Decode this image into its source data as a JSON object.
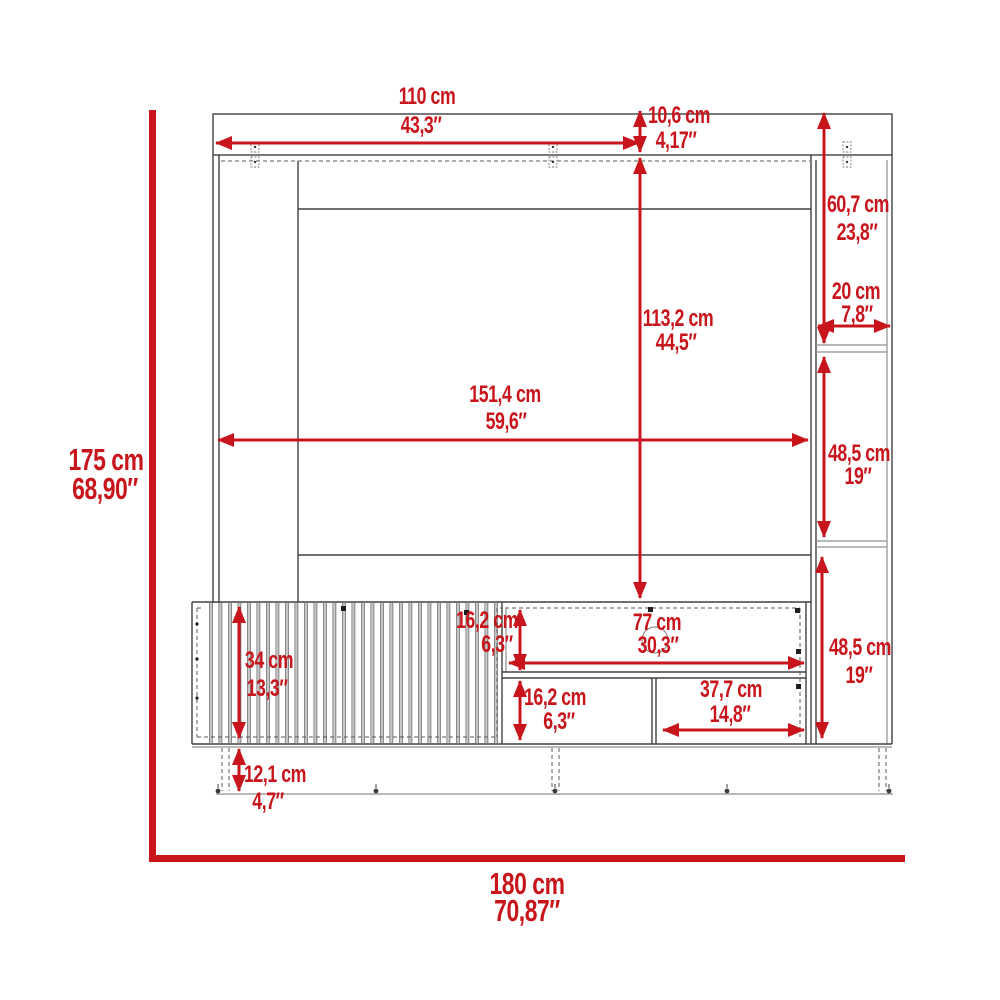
{
  "diagram": {
    "kind": "furniture-dimension-drawing",
    "colors": {
      "dimension_red": "#c8151c",
      "outline_dark": "#414141",
      "outline_gray": "#8f8f8f"
    },
    "overall": {
      "height": {
        "cm": "175 cm",
        "inch": "68,90″"
      },
      "width": {
        "cm": "180 cm",
        "inch": "70,87″"
      }
    },
    "dims": {
      "top_width": {
        "cm": "110 cm",
        "inch": "43,3″"
      },
      "top_height": {
        "cm": "10,6 cm",
        "inch": "4,17″"
      },
      "back_panel_height": {
        "cm": "113,2 cm",
        "inch": "44,5″"
      },
      "back_panel_width": {
        "cm": "151,4 cm",
        "inch": "59,6″"
      },
      "tower_upper_height": {
        "cm": "60,7 cm",
        "inch": "23,8″"
      },
      "tower_width": {
        "cm": "20 cm",
        "inch": "7,8″"
      },
      "tower_middle_height": {
        "cm": "48,5 cm",
        "inch": "19″"
      },
      "tower_lower_height": {
        "cm": "48,5 cm",
        "inch": "19″"
      },
      "console_height": {
        "cm": "34 cm",
        "inch": "13,3″"
      },
      "upper_shelf_height": {
        "cm": "16,2 cm",
        "inch": "6,3″"
      },
      "upper_shelf_width": {
        "cm": "77 cm",
        "inch": "30,3″"
      },
      "lower_shelf_height": {
        "cm": "16,2 cm",
        "inch": "6,3″"
      },
      "lower_shelf_width": {
        "cm": "37,7 cm",
        "inch": "14,8″"
      },
      "legs_height": {
        "cm": "12,1 cm",
        "inch": "4,7″"
      }
    }
  }
}
